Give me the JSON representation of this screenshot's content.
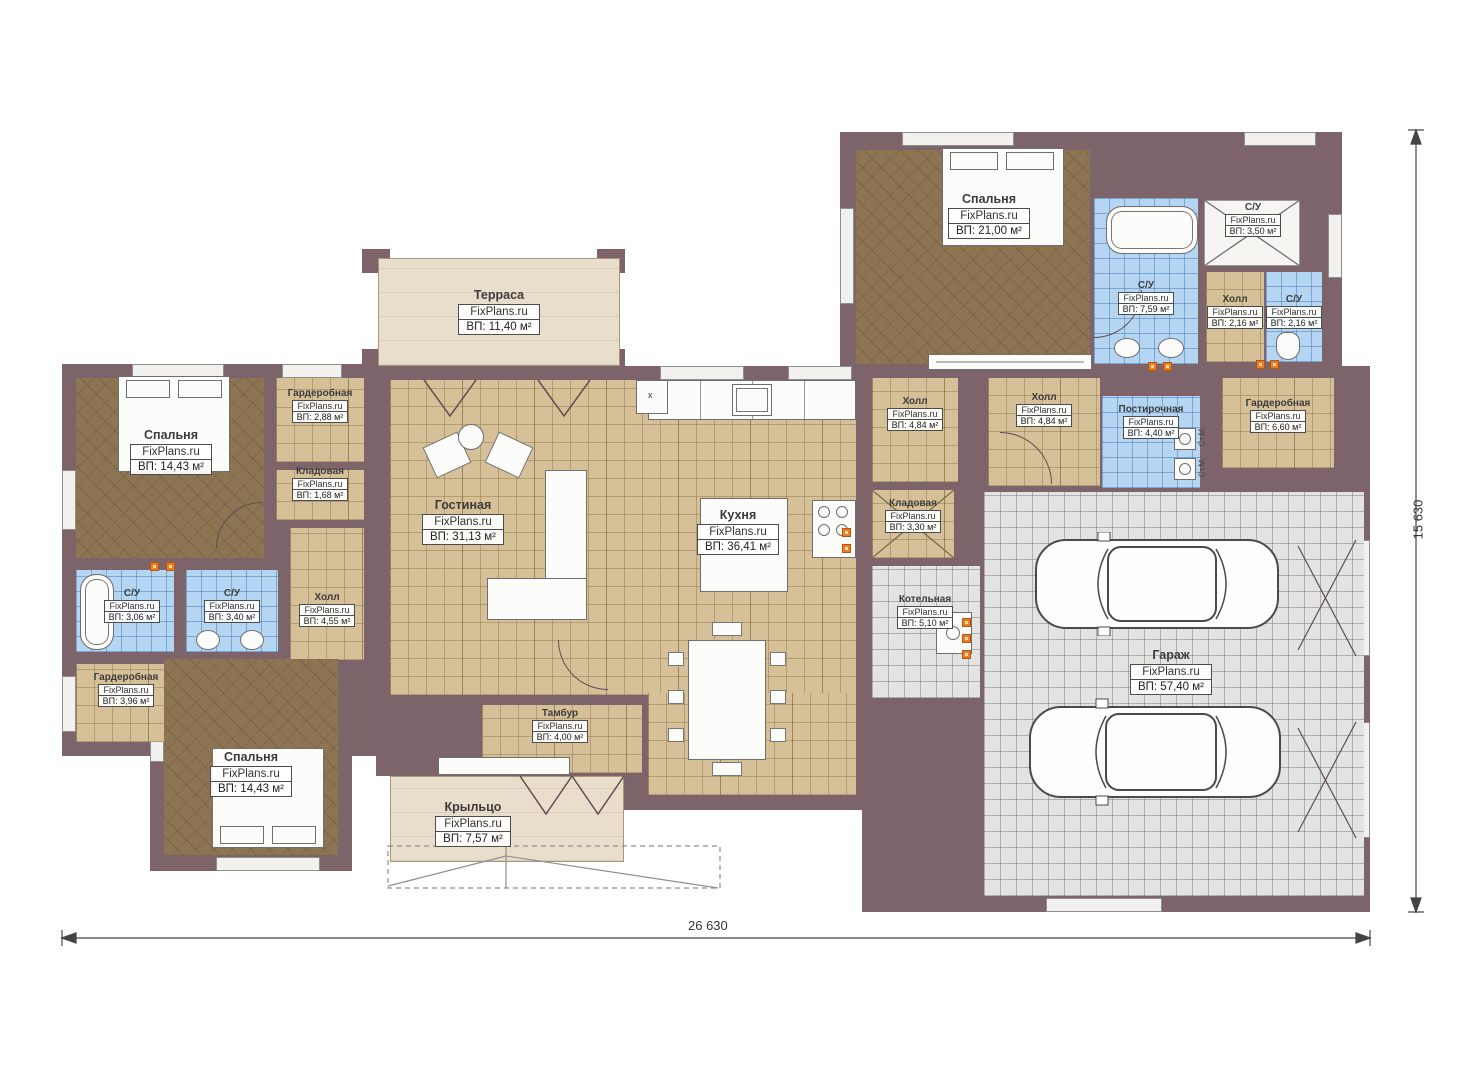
{
  "watermark": "FixPlans.ru",
  "rooms": [
    {
      "id": "bedroom-left-top",
      "name": "Спальня",
      "area": "ВП: 14,43 м²"
    },
    {
      "id": "wardrobe-left-top",
      "name": "Гардеробная",
      "area": "ВП: 2,88 м²"
    },
    {
      "id": "pantry-left",
      "name": "Кладовая",
      "area": "ВП: 1,68 м²"
    },
    {
      "id": "hall-left",
      "name": "Холл",
      "area": "ВП: 4,55 м²"
    },
    {
      "id": "bath-left-1",
      "name": "С/У",
      "area": "ВП: 3,06 м²"
    },
    {
      "id": "bath-left-2",
      "name": "С/У",
      "area": "ВП: 3,40 м²"
    },
    {
      "id": "wardrobe-left-bottom",
      "name": "Гардеробная",
      "area": "ВП: 3,96 м²"
    },
    {
      "id": "bedroom-left-bottom",
      "name": "Спальня",
      "area": "ВП: 14,43 м²"
    },
    {
      "id": "terrace",
      "name": "Терраса",
      "area": "ВП: 11,40 м²"
    },
    {
      "id": "living",
      "name": "Гостиная",
      "area": "ВП: 31,13 м²"
    },
    {
      "id": "kitchen",
      "name": "Кухня",
      "area": "ВП: 36,41 м²"
    },
    {
      "id": "tambour",
      "name": "Тамбур",
      "area": "ВП: 4,00 м²"
    },
    {
      "id": "porch",
      "name": "Крыльцо",
      "area": "ВП: 7,57 м²"
    },
    {
      "id": "bedroom-right",
      "name": "Спальня",
      "area": "ВП: 21,00 м²"
    },
    {
      "id": "bath-master",
      "name": "С/У",
      "area": "ВП: 7,59 м²"
    },
    {
      "id": "shower-top-right",
      "name": "С/У",
      "area": "ВП: 3,50 м²"
    },
    {
      "id": "hall-top-right",
      "name": "Холл",
      "area": "ВП: 2,16 м²"
    },
    {
      "id": "bath-top-right",
      "name": "С/У",
      "area": "ВП: 2,16 м²"
    },
    {
      "id": "hall-mid-1",
      "name": "Холл",
      "area": "ВП: 4,84 м²"
    },
    {
      "id": "hall-mid-2",
      "name": "Холл",
      "area": "ВП: 4,84 м²"
    },
    {
      "id": "laundry",
      "name": "Постирочная",
      "area": "ВП: 4,40 м²"
    },
    {
      "id": "wardrobe-right",
      "name": "Гардеробная",
      "area": "ВП: 6,60 м²"
    },
    {
      "id": "storage-mid",
      "name": "Кладовая",
      "area": "ВП: 3,30 м²"
    },
    {
      "id": "boiler",
      "name": "Котельная",
      "area": "ВП: 5,10 м²"
    },
    {
      "id": "garage",
      "name": "Гараж",
      "area": "ВП: 57,40 м²"
    }
  ],
  "dimensions": {
    "width_label": "26 630",
    "height_label": "15 630"
  },
  "annotations": {
    "washer_1": "Ст.М.",
    "washer_2": "Ст.М.",
    "x_mark": "х"
  }
}
